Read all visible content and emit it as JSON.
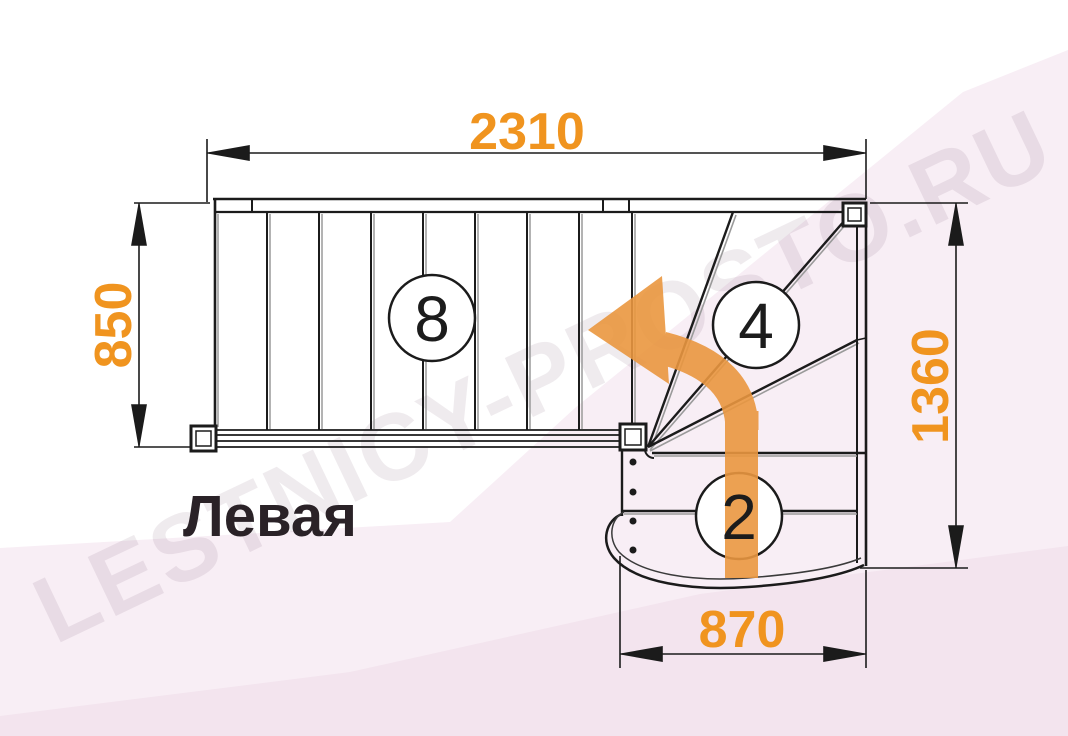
{
  "diagram": {
    "type": "staircase-floor-plan-top-view",
    "plan_label": "Левая",
    "watermark_text": "LESTNICY-PROSTO.RU",
    "dimensions": {
      "total_length_mm": "2310",
      "upper_flight_width_mm": "850",
      "right_side_depth_mm": "1360",
      "lower_flight_width_mm": "870"
    },
    "step_counts": {
      "straight_flight_steps": "8",
      "winder_steps": "4",
      "bottom_steps": "2"
    },
    "colors": {
      "dimension_text": "#f0941f",
      "turn_arrow": "#ea9740",
      "outline": "#1b1b1b",
      "secondary_line": "#9a9a9a",
      "background_pink": "#f8eef5",
      "background_pink_deep": "#f3e4ee",
      "label_text": "#2a2227"
    }
  }
}
